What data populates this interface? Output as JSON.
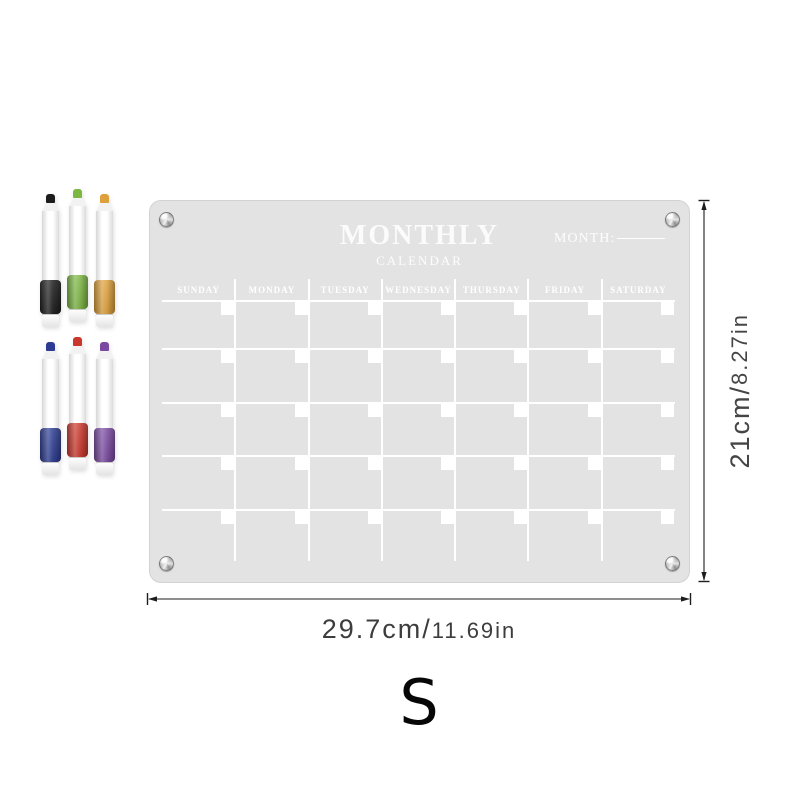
{
  "board": {
    "title": "MONTHLY",
    "subtitle": "CALENDAR",
    "month_label": "MONTH:",
    "days": [
      "SUNDAY",
      "MONDAY",
      "TUESDAY",
      "WEDNESDAY",
      "THURSDAY",
      "FRIDAY",
      "SATURDAY"
    ],
    "grid_rows": 5,
    "colors": {
      "board": "#e3e3e3",
      "lines": "#ffffff",
      "text": "#ffffff",
      "screw": "#a9a9a9"
    }
  },
  "markers": {
    "top_row": [
      {
        "name": "black",
        "color": "#1c1c1c"
      },
      {
        "name": "green",
        "color": "#7cb643"
      },
      {
        "name": "orange",
        "color": "#dda03a"
      }
    ],
    "bottom_row": [
      {
        "name": "blue",
        "color": "#2c3c92"
      },
      {
        "name": "red",
        "color": "#cb372c"
      },
      {
        "name": "purple",
        "color": "#7a49a1"
      }
    ]
  },
  "dimensions": {
    "height": {
      "metric": "21cm/",
      "imperial": "8.27in"
    },
    "width": {
      "metric": "29.7cm/",
      "imperial": "11.69in"
    }
  },
  "logo": "S"
}
